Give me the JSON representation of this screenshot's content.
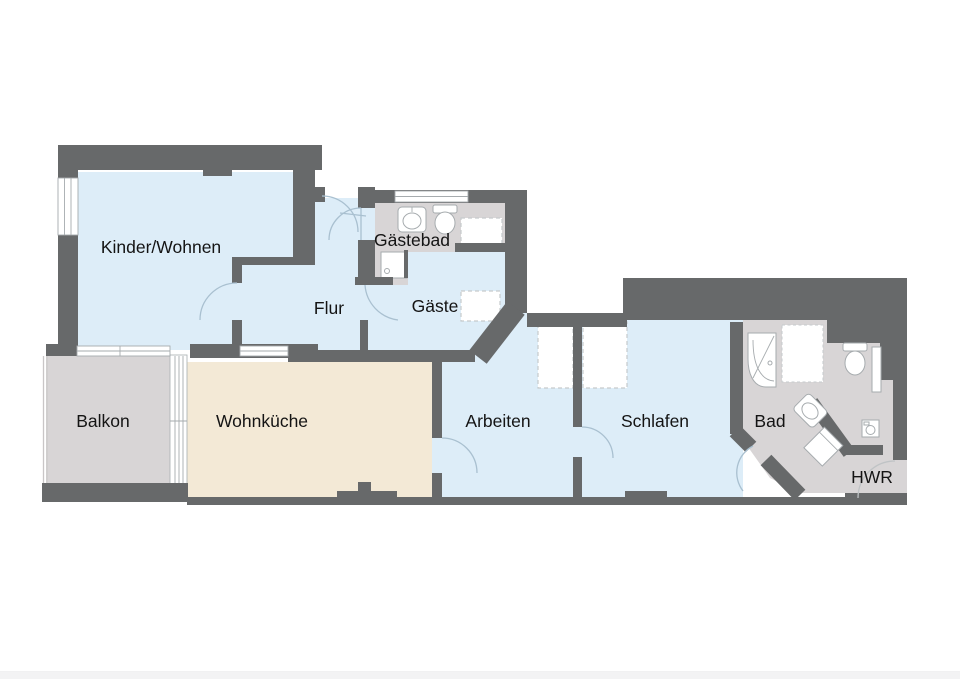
{
  "rooms": [
    {
      "id": "kinder-wohnen",
      "label": "Kinder/Wohnen"
    },
    {
      "id": "flur",
      "label": "Flur"
    },
    {
      "id": "gaestebad",
      "label": "Gästebad"
    },
    {
      "id": "gaeste",
      "label": "Gäste"
    },
    {
      "id": "balkon",
      "label": "Balkon"
    },
    {
      "id": "wohnkueche",
      "label": "Wohnküche"
    },
    {
      "id": "arbeiten",
      "label": "Arbeiten"
    },
    {
      "id": "schlafen",
      "label": "Schlafen"
    },
    {
      "id": "bad",
      "label": "Bad"
    },
    {
      "id": "hwr",
      "label": "HWR"
    }
  ],
  "fixtures": [
    "sink",
    "toilet",
    "shower-tray",
    "corner-bathtub",
    "shower-enclosure",
    "washing-machine",
    "wardrobe",
    "window",
    "door"
  ],
  "colors": {
    "wall": "#67696a",
    "floor_blue": "#ddedf8",
    "floor_gray": "#d8d5d6",
    "floor_beige": "#f3e9d6",
    "glass": "#ffffff",
    "fixture_stroke": "#a6abae",
    "dash_stroke": "#c6cacc",
    "arc_blue": "#a9c0d0",
    "arc_gray": "#bfc3c5",
    "text": "#141414",
    "page_bg": "#ffffff",
    "footer": "#f3f3f4",
    "railing": "#c9c6c7"
  }
}
